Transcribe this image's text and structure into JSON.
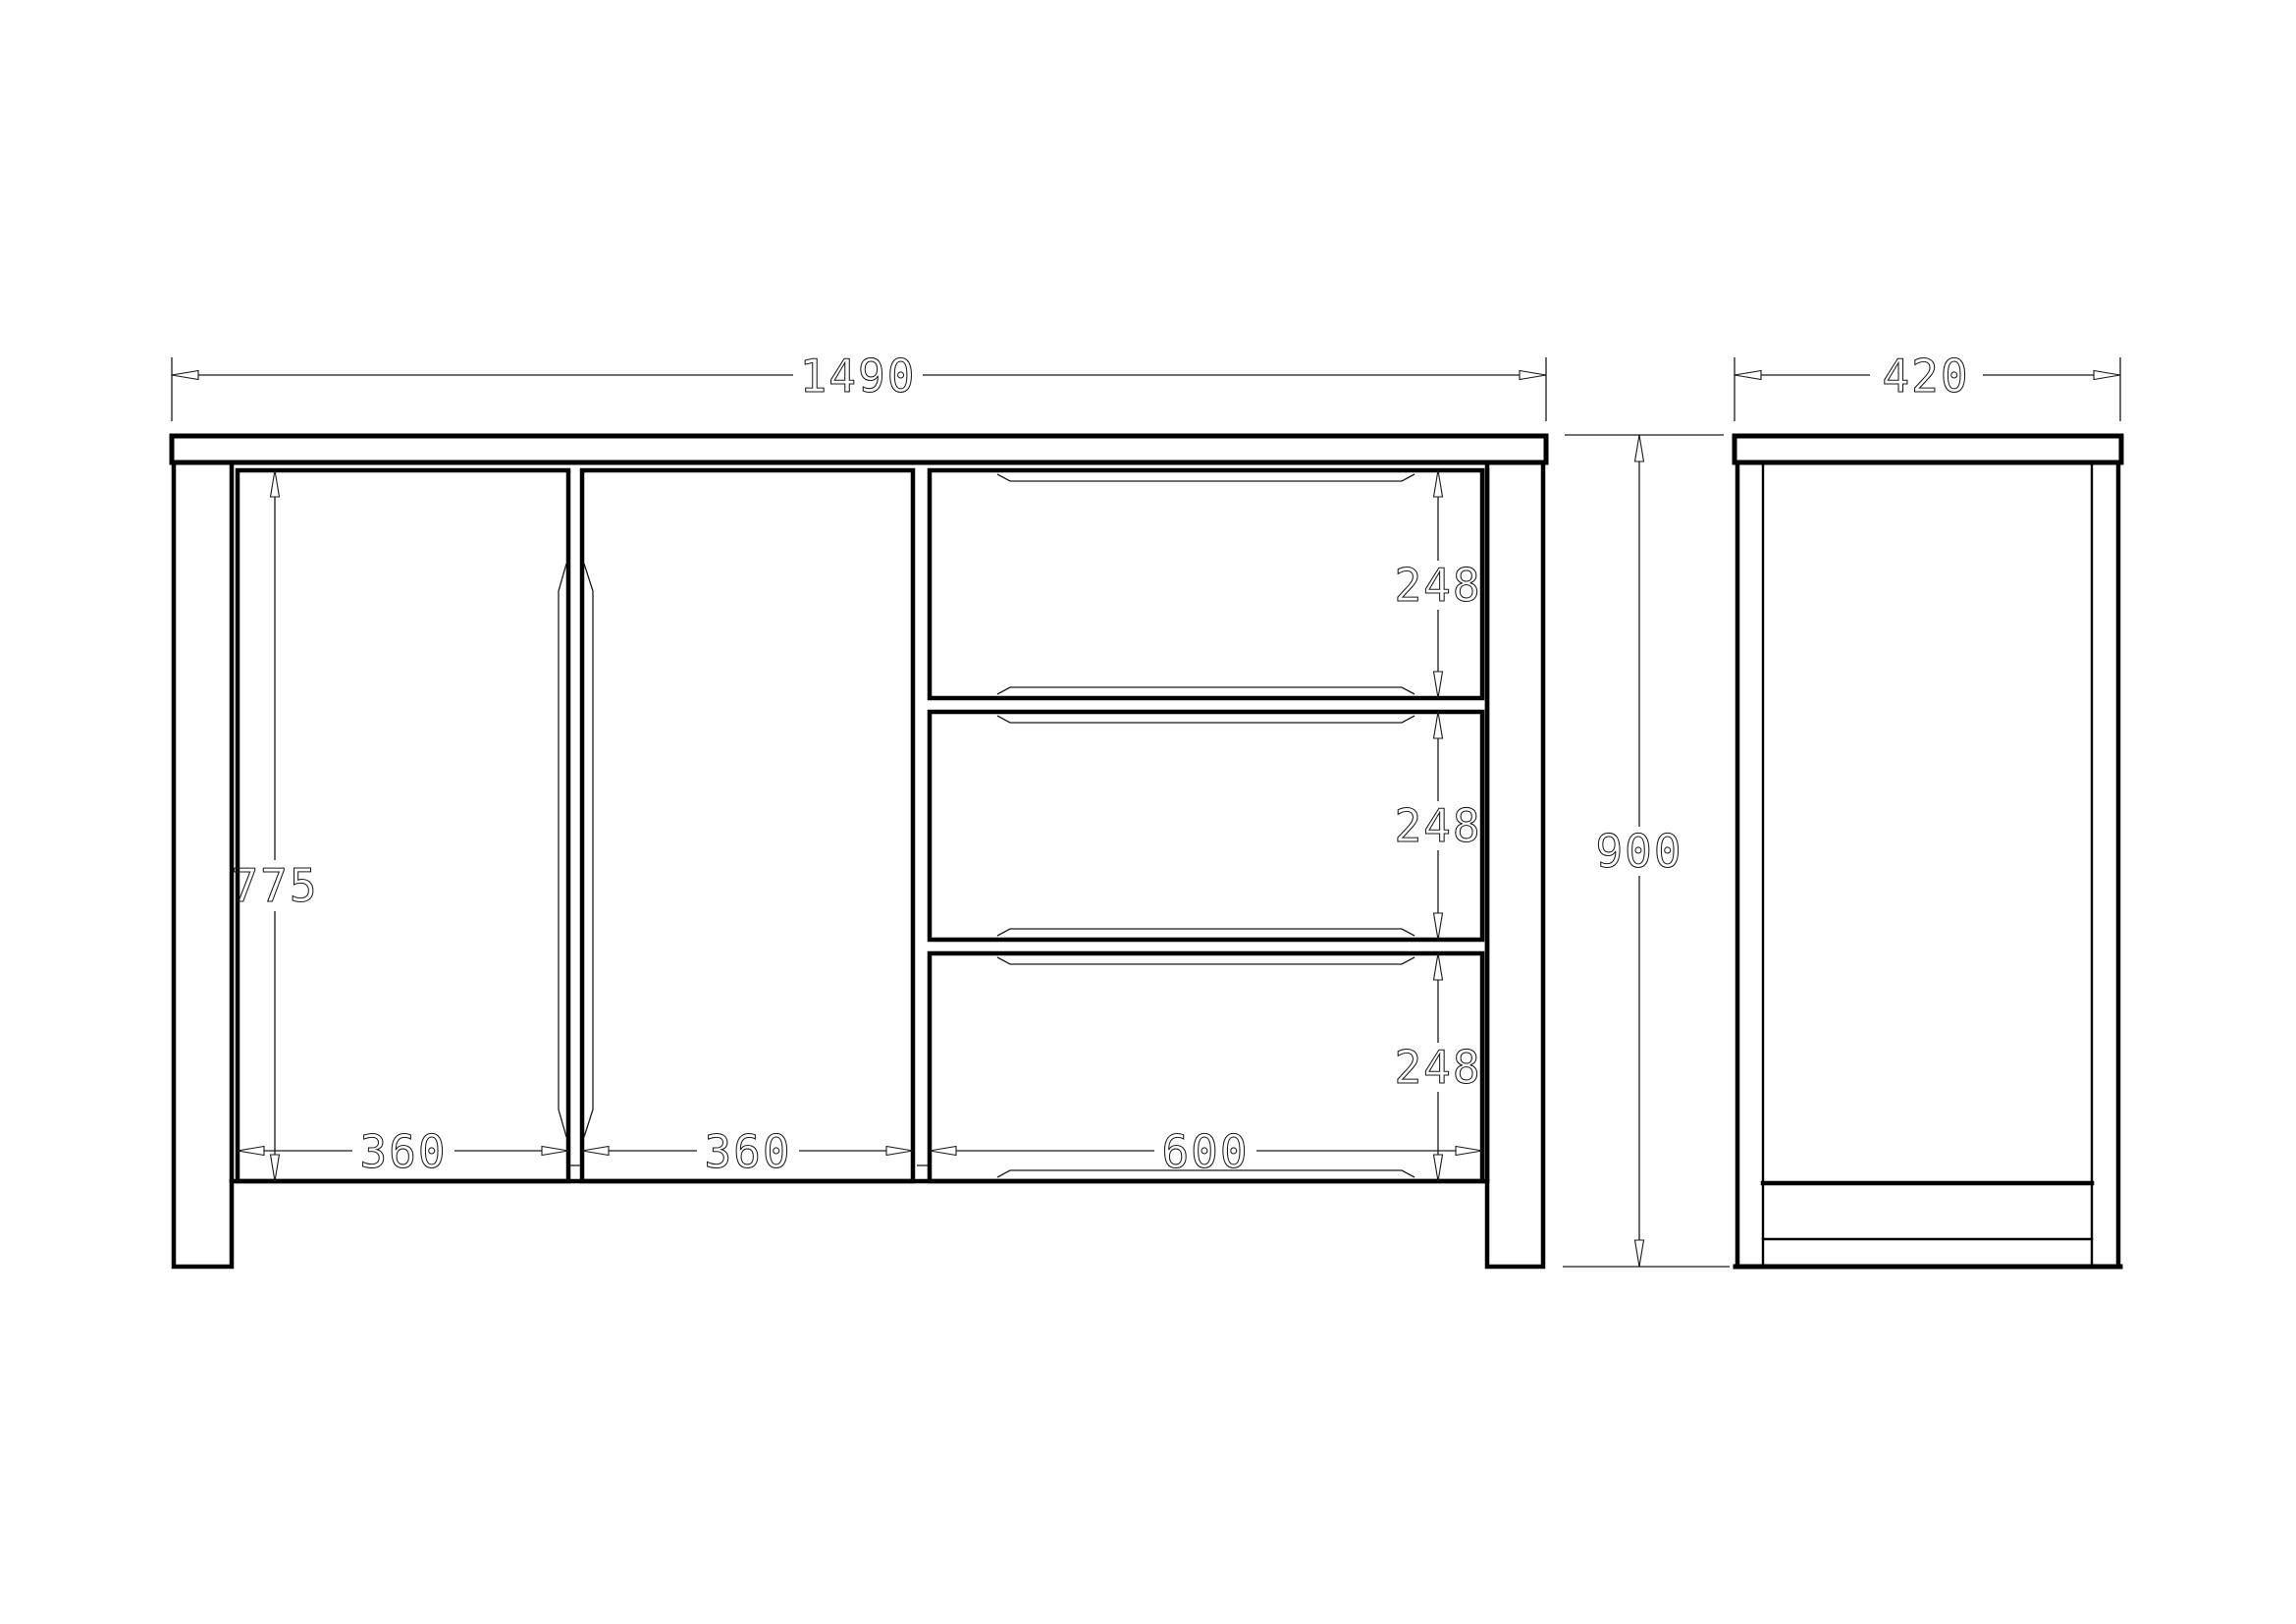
{
  "drawing": {
    "background_color": "#ffffff",
    "line_color": "#000000",
    "dims": {
      "overall_width": "1490",
      "depth": "420",
      "overall_height": "900",
      "door_height": "775",
      "left_door_width": "360",
      "right_door_width": "360",
      "drawer_width": "600",
      "drawer1_height": "248",
      "drawer2_height": "248",
      "drawer3_height": "248"
    }
  }
}
